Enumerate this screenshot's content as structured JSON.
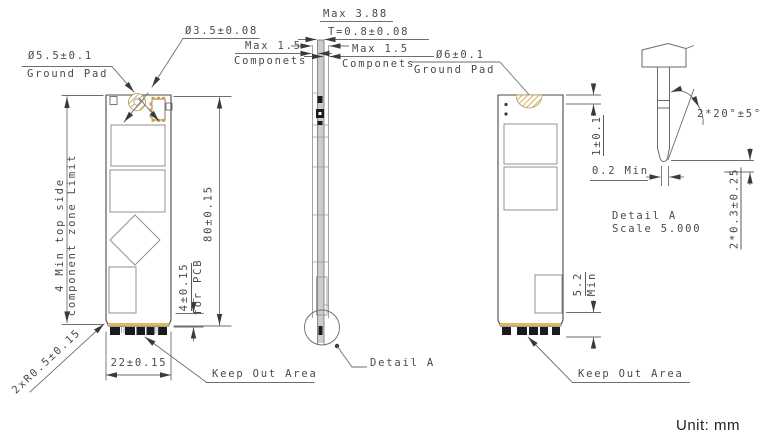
{
  "unit_label": "Unit: mm",
  "colors": {
    "line": "#4a4a4a",
    "dim_line": "#6e6e6e",
    "text": "#4a4a4a",
    "gold": "#cfa13d",
    "pad_black": "#1b1b1b",
    "background": "#ffffff"
  },
  "front_view": {
    "labels": {
      "ground_pad_dia": "Ø5.5±0.1",
      "ground_pad_caption": "Ground Pad",
      "hole_dia": "Ø3.5±0.08",
      "component_zone_line1": "4 Min top side",
      "component_zone_line2": "component zone Limit",
      "corner_radius": "2xR0.5±0.15",
      "width_dim": "22±0.15",
      "length_dim": "80±0.15",
      "pcb_edge_dim": "4±0.15",
      "pcb_edge_caption": "for PCB",
      "keep_out": "Keep Out Area"
    }
  },
  "side_view": {
    "labels": {
      "max_total_height": "Max 3.88",
      "thickness": "T=0.8±0.08",
      "comp_left_max": "Max 1.5",
      "comp_left_caption": "Componets",
      "comp_right_max": "Max 1.5",
      "comp_right_caption": "Componets",
      "detail_callout": "Detail A"
    }
  },
  "back_view": {
    "labels": {
      "ground_pad_dia": "Ø6±0.1",
      "ground_pad_caption": "Ground Pad",
      "top_edge_dim": "1±0.1",
      "bottom_zone_value": "5.2",
      "bottom_zone_caption": "Min",
      "keep_out": "Keep Out Area"
    }
  },
  "detail_a": {
    "labels": {
      "lead_in_angle": "2*20°±5°",
      "tip_width": "0.2 Min",
      "chamfer": "2*0.3±0.25",
      "title": "Detail A",
      "scale": "Scale 5.000"
    }
  }
}
